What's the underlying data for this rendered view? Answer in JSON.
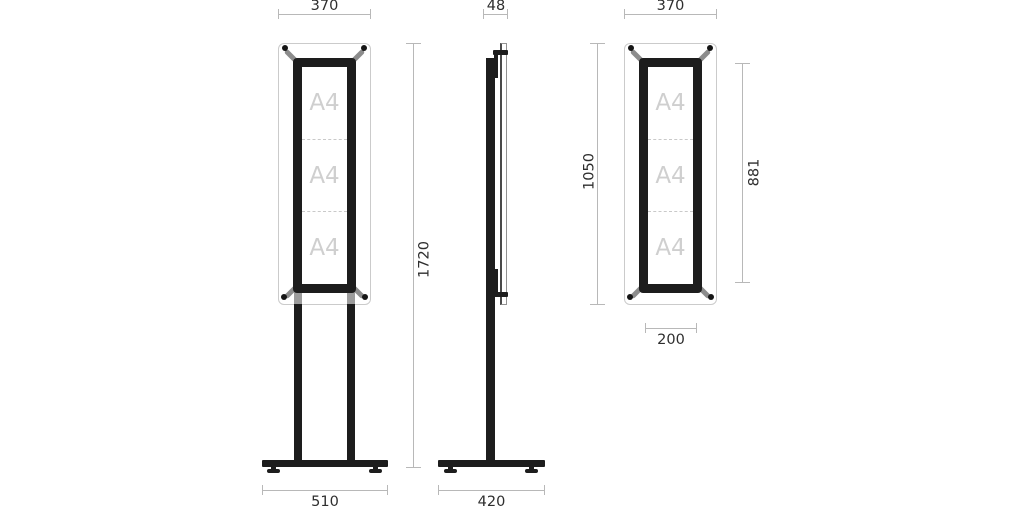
{
  "labels": {
    "a4": "A4"
  },
  "dimensions": {
    "front_width": "370",
    "depth": "48",
    "panel_width": "370",
    "total_height": "1720",
    "panel_height": "1050",
    "window_height": "881",
    "base_width": "510",
    "base_depth": "420",
    "clip_spacing": "200"
  },
  "colors": {
    "frame_black": "#1d1d1d",
    "panel_outline": "#cbcbcb",
    "dimension_line": "#b8b8b8",
    "dimension_text": "#2e2e2e",
    "a4_placeholder": "#cfcfcf"
  }
}
